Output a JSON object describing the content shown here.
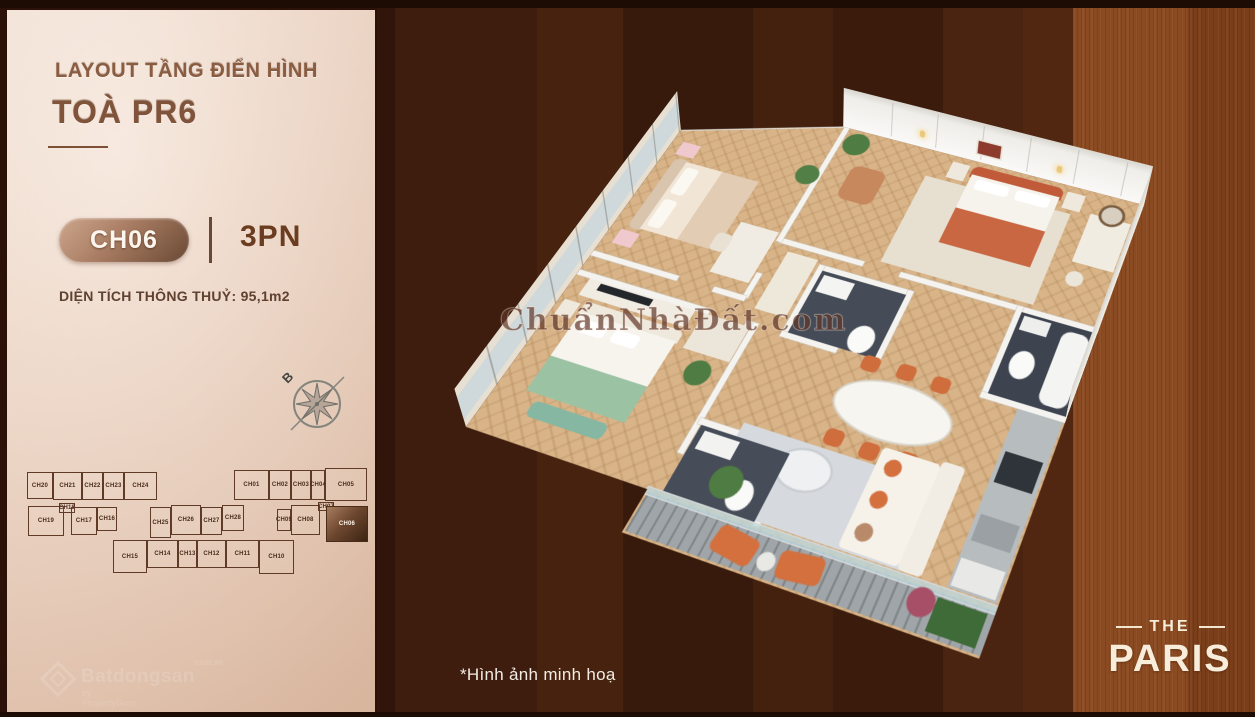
{
  "panel": {
    "title_line1": "LAYOUT TẦNG ĐIỂN HÌNH",
    "title_line2": "TOÀ PR6",
    "unit_badge": "CH06",
    "bedrooms_label": "3PN",
    "area_label": "DIỆN TÍCH THÔNG THUỶ: 95,1m2",
    "compass_label": "B"
  },
  "floor_diagram": {
    "units": [
      {
        "label": "CH20",
        "x": 8,
        "y": 10,
        "w": 26,
        "h": 27
      },
      {
        "label": "CH21",
        "x": 34,
        "y": 10,
        "w": 29,
        "h": 28
      },
      {
        "label": "CH22",
        "x": 63,
        "y": 10,
        "w": 21,
        "h": 28
      },
      {
        "label": "CH23",
        "x": 84,
        "y": 10,
        "w": 21,
        "h": 28
      },
      {
        "label": "CH24",
        "x": 105,
        "y": 10,
        "w": 33,
        "h": 28
      },
      {
        "label": "CH01",
        "x": 215,
        "y": 8,
        "w": 35,
        "h": 30
      },
      {
        "label": "CH02",
        "x": 250,
        "y": 8,
        "w": 22,
        "h": 30
      },
      {
        "label": "CH03",
        "x": 272,
        "y": 8,
        "w": 20,
        "h": 30
      },
      {
        "label": "CH04",
        "x": 292,
        "y": 8,
        "w": 14,
        "h": 30
      },
      {
        "label": "CH05",
        "x": 306,
        "y": 6,
        "w": 42,
        "h": 33
      },
      {
        "label": "CH19",
        "x": 9,
        "y": 44,
        "w": 36,
        "h": 30
      },
      {
        "label": "CH18",
        "x": 40,
        "y": 41,
        "w": 16,
        "h": 10
      },
      {
        "label": "CH17",
        "x": 52,
        "y": 45,
        "w": 26,
        "h": 28
      },
      {
        "label": "CH16",
        "x": 78,
        "y": 45,
        "w": 20,
        "h": 24
      },
      {
        "label": "CH25",
        "x": 131,
        "y": 45,
        "w": 21,
        "h": 31
      },
      {
        "label": "CH26",
        "x": 152,
        "y": 43,
        "w": 30,
        "h": 30
      },
      {
        "label": "CH27",
        "x": 182,
        "y": 45,
        "w": 21,
        "h": 28
      },
      {
        "label": "CH28",
        "x": 203,
        "y": 43,
        "w": 22,
        "h": 26
      },
      {
        "label": "CH09",
        "x": 258,
        "y": 47,
        "w": 14,
        "h": 22
      },
      {
        "label": "CH08",
        "x": 272,
        "y": 43,
        "w": 29,
        "h": 30
      },
      {
        "label": "CH07",
        "x": 299,
        "y": 40,
        "w": 16,
        "h": 9
      },
      {
        "label": "CH06",
        "x": 307,
        "y": 44,
        "w": 42,
        "h": 36,
        "hl": true
      },
      {
        "label": "CH15",
        "x": 94,
        "y": 78,
        "w": 34,
        "h": 33
      },
      {
        "label": "CH14",
        "x": 128,
        "y": 78,
        "w": 31,
        "h": 28
      },
      {
        "label": "CH13",
        "x": 159,
        "y": 78,
        "w": 19,
        "h": 28
      },
      {
        "label": "CH12",
        "x": 178,
        "y": 78,
        "w": 29,
        "h": 28
      },
      {
        "label": "CH11",
        "x": 207,
        "y": 78,
        "w": 33,
        "h": 28
      },
      {
        "label": "CH10",
        "x": 240,
        "y": 78,
        "w": 35,
        "h": 34
      }
    ]
  },
  "watermark_center": "ChuẩnNhàĐất.com",
  "watermark_corner": {
    "brand": "Batdongsan",
    "tld": "com.vn",
    "sub": "by PropertyGuru"
  },
  "disclaimer": "*Hình ảnh minh hoạ",
  "logo": {
    "top": "THE",
    "name": "PARIS"
  },
  "colors": {
    "background_dark": "#3b1a0c",
    "background_rust": "#8a4a22",
    "panel_beige": "#f0d8c7",
    "bronze_accent": "#8a5c41",
    "badge_gradient_dark": "#6a4935",
    "text_brown": "#5f4130",
    "highlight_unit": "#6e4830",
    "accent_terracotta": "#c96743",
    "accent_green": "#9cc2a4",
    "wood_floor": "#d8b488"
  }
}
